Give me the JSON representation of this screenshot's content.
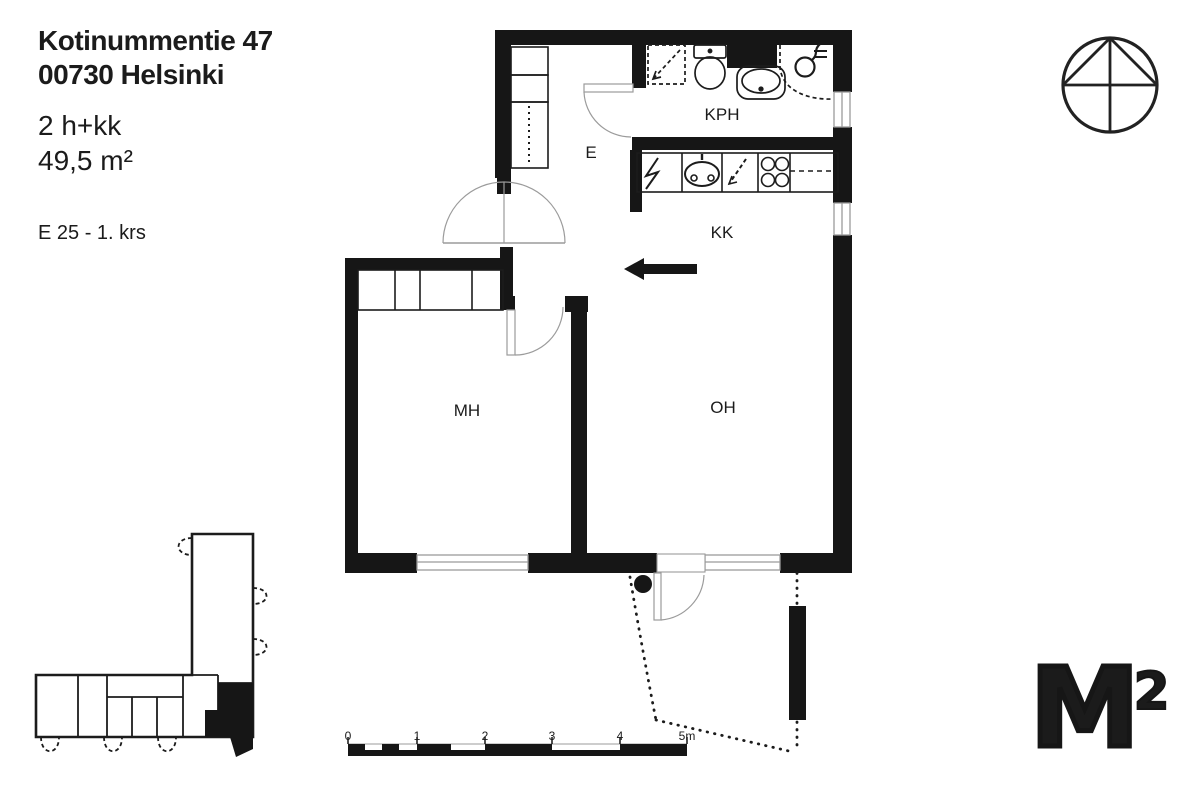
{
  "header": {
    "address_line1": "Kotinummentie 47",
    "address_line2": "00730 Helsinki",
    "apartment_type": "2 h+kk",
    "area": "49,5 m²",
    "unit_info": "E 25 - 1. krs"
  },
  "rooms": {
    "entry": "E",
    "bathroom": "KPH",
    "kitchenette": "KK",
    "bedroom": "MH",
    "living_room": "OH"
  },
  "scale_bar": {
    "labels": [
      "0",
      "1",
      "2",
      "3",
      "4",
      "5m"
    ]
  },
  "logo": {
    "m": "M",
    "sup": "2"
  },
  "colors": {
    "ink": "#1b1b1b",
    "thin_line": "#9b9b9b"
  }
}
